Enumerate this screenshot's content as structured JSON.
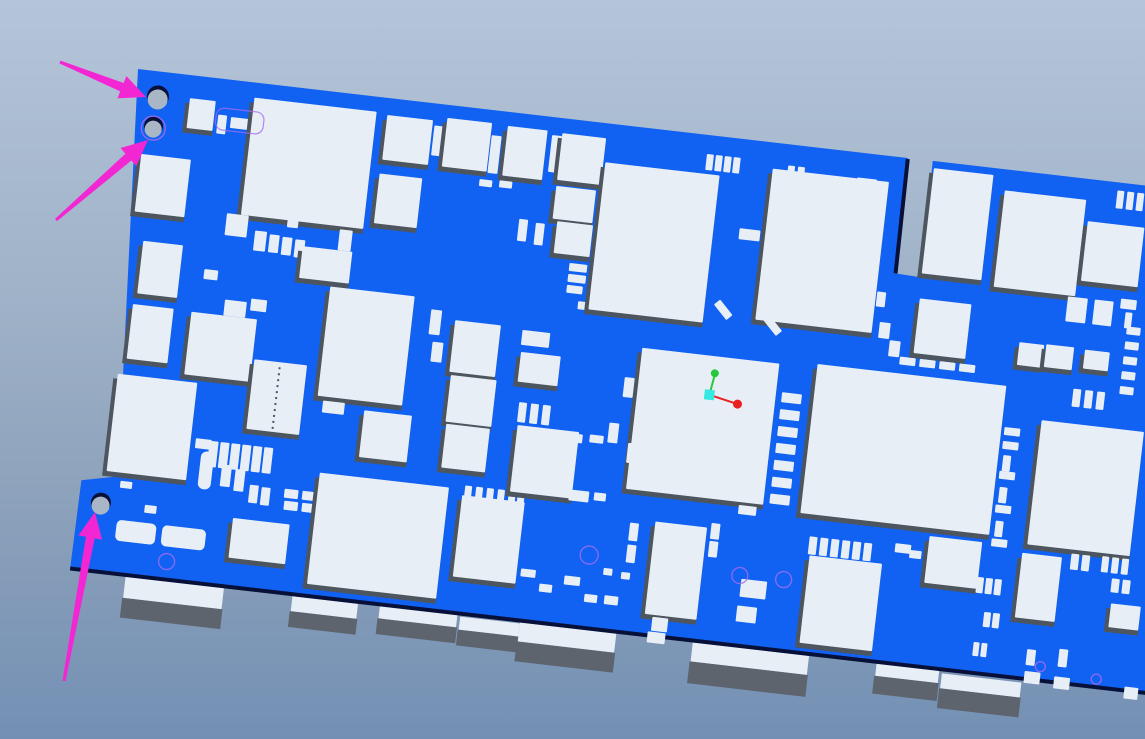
{
  "scene": {
    "app_context": "3D CAD PCB viewer",
    "description": "Tilted 3D view of a blue printed circuit board with white components; three magenta annotation arrows point at the two top-left mounting holes and the bottom-left mounting hole; small XYZ axis triad shown on the large center IC; edge connectors protrude below the lower board edge",
    "width": 1145,
    "height": 739
  },
  "colors": {
    "bg_top": "#b5c5d9",
    "bg_bottom": "#7390b4",
    "board": "#1162f2",
    "component": "#e8eef6",
    "component_shadow": "#4d555e",
    "connector_side": "#5d646d",
    "board_edge": "#061038",
    "hole": "#a9b6c6",
    "outline": "#a36cf0",
    "arrow": "#f326d4",
    "axis_x": "#e82222",
    "axis_y": "#27c840",
    "axis_origin": "#35e8e0"
  },
  "board": {
    "transform": [
      0.9934,
      0.1149,
      -0.1149,
      0.9934,
      138,
      69
    ],
    "outline": [
      [
        0,
        0
      ],
      [
        775,
        0
      ],
      [
        776,
        116
      ],
      [
        802,
        117
      ],
      [
        800,
        0
      ],
      [
        1100,
        0
      ],
      [
        1100,
        504
      ],
      [
        -10,
        504
      ],
      [
        -9,
        415
      ],
      [
        27,
        407
      ]
    ],
    "edge_lines": [
      [
        -10,
        504,
        1100,
        504
      ],
      [
        775,
        1,
        776,
        116
      ]
    ]
  },
  "holes": [
    {
      "x": 23,
      "y": 27,
      "r": 11,
      "ring": false
    },
    {
      "x": 22,
      "y": 57,
      "r": 9.5,
      "ring": true
    },
    {
      "x": 13,
      "y": 437,
      "r": 10,
      "ring": false
    }
  ],
  "components": [
    [
      55,
      23,
      26,
      30,
      1
    ],
    [
      85,
      36,
      9,
      19,
      0
    ],
    [
      98,
      37,
      24,
      11,
      0
    ],
    [
      118,
      30,
      9,
      20,
      0
    ],
    [
      119,
      15,
      123,
      118,
      1
    ],
    [
      253,
      17,
      46,
      45,
      1
    ],
    [
      301,
      22,
      11,
      30,
      0
    ],
    [
      313,
      13,
      45,
      49,
      1
    ],
    [
      359,
      25,
      10,
      38,
      0
    ],
    [
      374,
      14,
      40,
      50,
      1
    ],
    [
      419,
      18,
      10,
      37,
      0
    ],
    [
      429,
      15,
      44,
      47,
      1
    ],
    [
      252,
      76,
      43,
      50,
      1
    ],
    [
      352,
      70,
      13,
      7,
      0
    ],
    [
      372,
      69,
      13,
      7,
      0
    ],
    [
      13,
      84,
      50,
      58,
      1
    ],
    [
      25,
      170,
      40,
      53,
      1
    ],
    [
      22,
      234,
      41,
      55,
      1
    ],
    [
      15,
      305,
      80,
      98,
      1
    ],
    [
      105,
      133,
      22,
      22,
      0
    ],
    [
      135,
      147,
      12,
      20,
      0
    ],
    [
      150,
      149,
      10,
      18,
      0
    ],
    [
      163,
      150,
      10,
      18,
      0
    ],
    [
      176,
      151,
      10,
      18,
      0
    ],
    [
      89,
      191,
      14,
      10,
      0
    ],
    [
      113,
      219,
      22,
      16,
      0
    ],
    [
      139,
      215,
      16,
      12,
      0
    ],
    [
      166,
      116,
      11,
      24,
      0
    ],
    [
      219,
      136,
      13,
      21,
      0
    ],
    [
      184,
      157,
      50,
      32,
      1
    ],
    [
      81,
      235,
      66,
      63,
      1
    ],
    [
      149,
      275,
      53,
      70,
      1
    ],
    [
      216,
      194,
      85,
      110,
      1
    ],
    [
      222,
      308,
      22,
      12,
      0
    ],
    [
      264,
      313,
      48,
      47,
      1
    ],
    [
      100,
      360,
      16,
      10,
      0
    ],
    [
      107,
      372,
      13,
      38,
      0,
      0,
      6
    ],
    [
      114,
      361,
      9,
      26,
      0
    ],
    [
      125,
      361,
      9,
      26,
      0
    ],
    [
      136,
      361,
      9,
      26,
      0
    ],
    [
      147,
      361,
      9,
      26,
      0
    ],
    [
      158,
      361,
      9,
      26,
      0
    ],
    [
      169,
      361,
      9,
      26,
      0
    ],
    [
      129,
      383,
      10,
      22,
      0
    ],
    [
      143,
      386,
      10,
      22,
      0
    ],
    [
      159,
      400,
      9,
      18,
      0
    ],
    [
      171,
      401,
      9,
      18,
      0
    ],
    [
      194,
      400,
      14,
      9,
      0
    ],
    [
      195,
      412,
      14,
      9,
      0
    ],
    [
      212,
      400,
      14,
      9,
      0
    ],
    [
      213,
      412,
      14,
      9,
      0
    ],
    [
      146,
      435,
      57,
      40,
      1
    ],
    [
      227,
      380,
      130,
      112,
      1
    ],
    [
      30,
      411,
      12,
      7,
      0
    ],
    [
      57,
      432,
      12,
      8,
      0
    ],
    [
      31,
      450,
      40,
      21,
      0,
      0,
      5
    ],
    [
      77,
      450,
      44,
      21,
      0,
      0,
      5
    ],
    [
      344,
      213,
      46,
      52,
      1
    ],
    [
      346,
      268,
      46,
      47,
      1
    ],
    [
      347,
      317,
      44,
      44,
      1
    ],
    [
      319,
      205,
      11,
      25,
      0
    ],
    [
      324,
      237,
      11,
      20,
      0
    ],
    [
      371,
      386,
      63,
      82,
      1
    ],
    [
      373,
      376,
      7,
      12,
      0
    ],
    [
      384,
      376,
      7,
      12,
      0
    ],
    [
      395,
      376,
      7,
      12,
      0
    ],
    [
      406,
      376,
      7,
      12,
      0
    ],
    [
      417,
      376,
      7,
      12,
      0
    ],
    [
      426,
      376,
      7,
      12,
      0
    ],
    [
      396,
      105,
      9,
      22,
      0
    ],
    [
      413,
      107,
      9,
      22,
      0
    ],
    [
      412,
      215,
      28,
      15,
      0
    ],
    [
      413,
      237,
      40,
      30,
      1
    ],
    [
      417,
      287,
      8,
      20,
      0
    ],
    [
      429,
      287,
      8,
      20,
      0
    ],
    [
      441,
      287,
      8,
      20,
      0
    ],
    [
      418,
      310,
      62,
      67,
      1
    ],
    [
      429,
      68,
      40,
      33,
      1
    ],
    [
      434,
      103,
      36,
      32,
      1
    ],
    [
      451,
      143,
      18,
      8,
      0
    ],
    [
      451,
      154,
      18,
      8,
      0
    ],
    [
      451,
      165,
      16,
      8,
      0
    ],
    [
      464,
      180,
      14,
      8,
      0
    ],
    [
      466,
      312,
      18,
      9,
      0
    ],
    [
      491,
      311,
      14,
      8,
      0
    ],
    [
      477,
      368,
      20,
      11,
      0
    ],
    [
      502,
      368,
      12,
      8,
      0
    ],
    [
      475,
      39,
      115,
      148,
      1
    ],
    [
      642,
      26,
      117,
      152,
      1
    ],
    [
      575,
      19,
      7,
      16,
      0
    ],
    [
      584,
      19,
      7,
      16,
      0
    ],
    [
      593,
      19,
      7,
      16,
      0
    ],
    [
      602,
      19,
      7,
      16,
      0
    ],
    [
      657,
      21,
      7,
      16,
      0
    ],
    [
      667,
      21,
      7,
      16,
      0
    ],
    [
      727,
      25,
      20,
      9,
      0
    ],
    [
      616,
      89,
      21,
      11,
      0
    ],
    [
      599,
      168,
      20,
      8,
      0,
      45
    ],
    [
      650,
      178,
      20,
      8,
      0,
      45
    ],
    [
      533,
      219,
      138,
      142,
      1
    ],
    [
      519,
      250,
      10,
      20,
      0
    ],
    [
      509,
      297,
      10,
      20,
      0
    ],
    [
      530,
      315,
      10,
      20,
      0
    ],
    [
      677,
      247,
      20,
      10,
      0
    ],
    [
      677,
      264,
      20,
      10,
      0
    ],
    [
      677,
      281,
      20,
      10,
      0
    ],
    [
      677,
      298,
      20,
      10,
      0
    ],
    [
      677,
      315,
      20,
      10,
      0
    ],
    [
      677,
      332,
      20,
      10,
      0
    ],
    [
      677,
      349,
      20,
      10,
      0
    ],
    [
      647,
      316,
      18,
      9,
      0
    ],
    [
      647,
      332,
      18,
      9,
      0
    ],
    [
      647,
      348,
      18,
      9,
      0
    ],
    [
      647,
      364,
      18,
      9,
      0
    ],
    [
      566,
      390,
      52,
      93,
      1
    ],
    [
      541,
      394,
      9,
      18,
      0
    ],
    [
      541,
      416,
      9,
      18,
      0
    ],
    [
      622,
      385,
      9,
      16,
      0
    ],
    [
      622,
      403,
      9,
      16,
      0
    ],
    [
      721,
      387,
      8,
      18,
      0
    ],
    [
      732,
      387,
      8,
      18,
      0
    ],
    [
      743,
      387,
      8,
      18,
      0
    ],
    [
      754,
      387,
      8,
      18,
      0
    ],
    [
      765,
      387,
      8,
      18,
      0
    ],
    [
      776,
      387,
      8,
      18,
      0
    ],
    [
      807,
      384,
      16,
      9,
      0
    ],
    [
      658,
      437,
      26,
      18,
      0
    ],
    [
      657,
      464,
      20,
      16,
      0
    ],
    [
      520,
      442,
      9,
      7,
      0
    ],
    [
      538,
      444,
      9,
      7,
      0
    ],
    [
      438,
      452,
      15,
      8,
      0
    ],
    [
      458,
      465,
      13,
      8,
      0
    ],
    [
      482,
      454,
      16,
      9,
      0
    ],
    [
      504,
      470,
      13,
      8,
      0
    ],
    [
      567,
      464,
      14,
      9,
      0
    ],
    [
      574,
      485,
      16,
      14,
      0
    ],
    [
      524,
      469,
      14,
      9,
      0
    ],
    [
      571,
      500,
      18,
      11,
      0
    ],
    [
      790,
      198,
      16,
      8,
      0
    ],
    [
      810,
      198,
      16,
      8,
      0
    ],
    [
      830,
      198,
      16,
      8,
      0
    ],
    [
      850,
      198,
      16,
      8,
      0
    ],
    [
      709,
      215,
      190,
      150,
      1
    ],
    [
      803,
      138,
      52,
      55,
      1
    ],
    [
      802,
      7,
      60,
      106,
      1
    ],
    [
      875,
      21,
      82,
      97,
      1
    ],
    [
      961,
      42,
      57,
      60,
      1
    ],
    [
      987,
      8,
      7,
      18,
      0
    ],
    [
      997,
      8,
      7,
      18,
      0
    ],
    [
      1007,
      8,
      7,
      18,
      0
    ],
    [
      746,
      95,
      9,
      14,
      0
    ],
    [
      760,
      136,
      9,
      15,
      0
    ],
    [
      766,
      166,
      11,
      16,
      0
    ],
    [
      778,
      183,
      11,
      16,
      0
    ],
    [
      950,
      119,
      20,
      25,
      0
    ],
    [
      977,
      119,
      19,
      25,
      0
    ],
    [
      1003,
      115,
      16,
      10,
      0
    ],
    [
      1009,
      128,
      7,
      16,
      0
    ],
    [
      907,
      170,
      25,
      23,
      1
    ],
    [
      934,
      169,
      28,
      23,
      1
    ],
    [
      973,
      170,
      25,
      19,
      1
    ],
    [
      938,
      245,
      103,
      125,
      1
    ],
    [
      902,
      256,
      16,
      8,
      0
    ],
    [
      902,
      270,
      16,
      8,
      0
    ],
    [
      904,
      284,
      8,
      16,
      0
    ],
    [
      902,
      300,
      16,
      8,
      0
    ],
    [
      904,
      316,
      8,
      16,
      0
    ],
    [
      902,
      334,
      16,
      8,
      0
    ],
    [
      904,
      350,
      8,
      16,
      0
    ],
    [
      902,
      368,
      16,
      8,
      0
    ],
    [
      1012,
      142,
      14,
      8,
      0
    ],
    [
      1012,
      157,
      14,
      8,
      0
    ],
    [
      1012,
      172,
      14,
      8,
      0
    ],
    [
      1012,
      187,
      14,
      8,
      0
    ],
    [
      1012,
      202,
      14,
      8,
      0
    ],
    [
      966,
      210,
      8,
      18,
      0
    ],
    [
      978,
      210,
      8,
      18,
      0
    ],
    [
      990,
      210,
      8,
      18,
      0
    ],
    [
      723,
      406,
      73,
      88,
      1
    ],
    [
      822,
      389,
      12,
      8,
      0
    ],
    [
      838,
      389,
      12,
      8,
      0
    ],
    [
      840,
      373,
      53,
      47,
      1
    ],
    [
      934,
      379,
      40,
      65,
      1
    ],
    [
      892,
      408,
      7,
      16,
      0
    ],
    [
      901,
      408,
      7,
      16,
      0
    ],
    [
      910,
      408,
      7,
      16,
      0
    ],
    [
      903,
      442,
      7,
      15,
      0
    ],
    [
      912,
      442,
      7,
      15,
      0
    ],
    [
      896,
      473,
      6,
      14,
      0
    ],
    [
      904,
      473,
      6,
      14,
      0
    ],
    [
      950,
      474,
      9,
      16,
      0
    ],
    [
      982,
      470,
      9,
      18,
      0
    ],
    [
      983,
      374,
      8,
      16,
      0
    ],
    [
      994,
      374,
      8,
      16,
      0
    ],
    [
      1014,
      373,
      7,
      16,
      0
    ],
    [
      1024,
      373,
      7,
      16,
      0
    ],
    [
      1034,
      373,
      7,
      16,
      0
    ],
    [
      1026,
      394,
      8,
      14,
      0
    ],
    [
      1037,
      394,
      8,
      14,
      0
    ],
    [
      1028,
      419,
      30,
      24,
      1
    ],
    [
      950,
      496,
      16,
      12,
      0
    ],
    [
      980,
      498,
      16,
      12,
      0
    ],
    [
      1051,
      500,
      14,
      12,
      0
    ]
  ],
  "outlines": {
    "circles": [
      [
        504,
        431,
        9
      ],
      [
        656,
        434,
        8
      ],
      [
        700,
        433,
        8
      ],
      [
        85,
        486,
        8
      ],
      [
        965,
        490,
        5
      ],
      [
        1022,
        496,
        5
      ]
    ],
    "rects": [
      [
        83,
        29,
        48,
        22
      ]
    ],
    "dashes": [
      [
        175,
        280,
        175,
        343
      ]
    ]
  },
  "connectors": [
    {
      "x": 46,
      "y": 505,
      "w": 99,
      "t": 22,
      "f": 20
    },
    {
      "x": 214,
      "y": 506,
      "w": 66,
      "t": 15,
      "f": 16
    },
    {
      "x": 302,
      "y": 505,
      "w": 78,
      "t": 13,
      "f": 16
    },
    {
      "x": 383,
      "y": 507,
      "w": 60,
      "t": 13,
      "f": 16
    },
    {
      "x": 443,
      "y": 506,
      "w": 97,
      "t": 19,
      "f": 20
    },
    {
      "x": 617,
      "y": 506,
      "w": 117,
      "t": 19,
      "f": 22
    },
    {
      "x": 802,
      "y": 503,
      "w": 63,
      "t": 15,
      "f": 18
    },
    {
      "x": 868,
      "y": 508,
      "w": 80,
      "t": 15,
      "f": 20
    }
  ],
  "axis": {
    "origin": [
      605,
      258
    ],
    "x_end": [
      634,
      264
    ],
    "y_end": [
      608,
      238
    ]
  },
  "arrows": [
    {
      "x1": 60,
      "y1": 62,
      "x2": 146,
      "y2": 97
    },
    {
      "x1": 56,
      "y1": 220,
      "x2": 148,
      "y2": 140
    },
    {
      "x1": 64,
      "y1": 681,
      "x2": 95,
      "y2": 512
    }
  ],
  "arrow_style": {
    "head_l": 26,
    "head_w": 24,
    "tail_w": 3,
    "shaft_w": 9
  }
}
